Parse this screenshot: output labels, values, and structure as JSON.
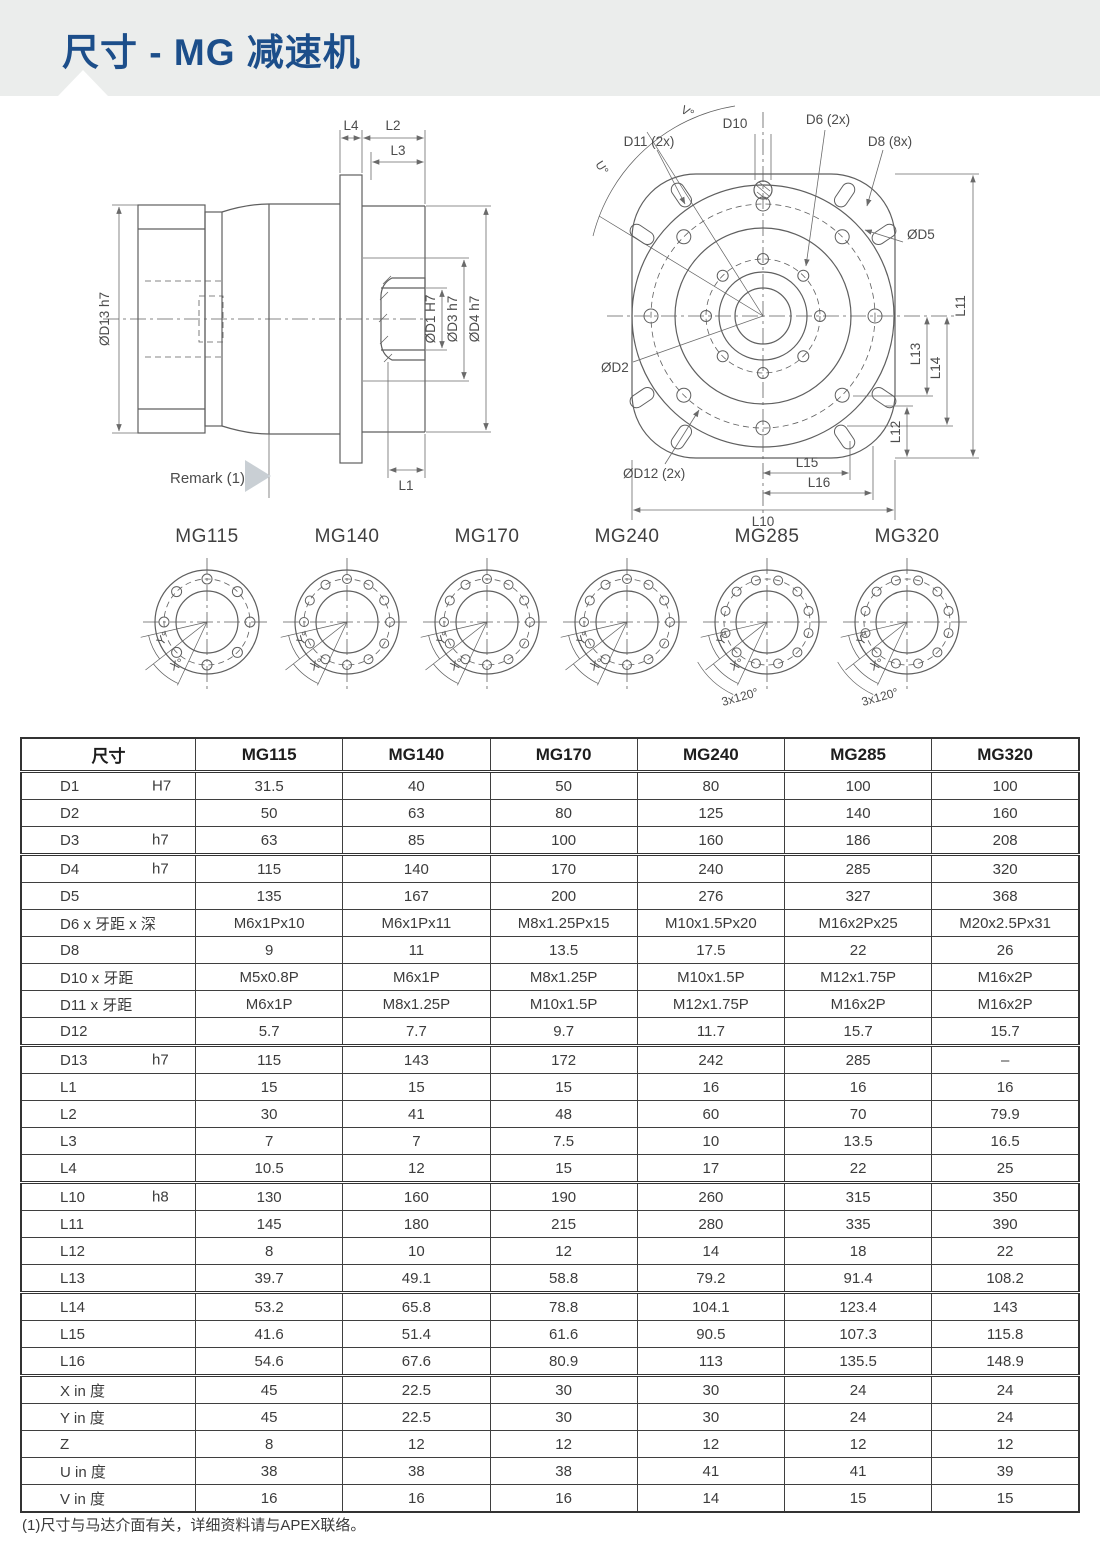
{
  "page": {
    "title": "尺寸 - MG 减速机",
    "footnote": "(1)尺寸与马达介面有关，详细资料请与APEX联络。"
  },
  "colors": {
    "accent": "#1c4e8a",
    "band": "#ebedec",
    "line": "#5f5f5f",
    "table_border": "#333333"
  },
  "drawings": {
    "side_view": {
      "dims": {
        "l4": "L4",
        "l2": "L2",
        "l3": "L3",
        "l1": "L1",
        "d13": "ØD13 h7",
        "d1": "ØD1 H7",
        "d3": "ØD3 h7",
        "d4": "ØD4 h7"
      },
      "remark": "Remark (1)"
    },
    "front_view": {
      "dims": {
        "d10": "D10",
        "d6": "D6 (2x)",
        "d8": "D8 (8x)",
        "d11": "D11 (2x)",
        "d5": "ØD5",
        "d2": "ØD2",
        "d12": "ØD12 (2x)",
        "l15": "L15",
        "l16": "L16",
        "l10": "L10",
        "l11": "L11",
        "l12": "L12",
        "l13": "L13",
        "l14": "L14",
        "v": "V°",
        "u": "U°"
      }
    },
    "flanges": [
      {
        "name": "MG115",
        "holes": 8,
        "y_label": "Y°",
        "x_label": "X°",
        "extra": ""
      },
      {
        "name": "MG140",
        "holes": 12,
        "y_label": "Y°",
        "x_label": "X°",
        "extra": ""
      },
      {
        "name": "MG170",
        "holes": 12,
        "y_label": "Y°",
        "x_label": "X°",
        "extra": ""
      },
      {
        "name": "MG240",
        "holes": 12,
        "y_label": "Y°",
        "x_label": "X°",
        "extra": ""
      },
      {
        "name": "MG285",
        "holes": 12,
        "y_label": "Y°",
        "x_label": "X°",
        "extra": "3x120°"
      },
      {
        "name": "MG320",
        "holes": 12,
        "y_label": "Y°",
        "x_label": "X°",
        "extra": "3x120°"
      }
    ]
  },
  "table": {
    "header": [
      "尺寸",
      "MG115",
      "MG140",
      "MG170",
      "MG240",
      "MG285",
      "MG320"
    ],
    "rows": [
      {
        "label": "D1",
        "tol": "H7",
        "values": [
          "31.5",
          "40",
          "50",
          "80",
          "100",
          "100"
        ]
      },
      {
        "label": "D2",
        "tol": "",
        "values": [
          "50",
          "63",
          "80",
          "125",
          "140",
          "160"
        ]
      },
      {
        "label": "D3",
        "tol": "h7",
        "values": [
          "63",
          "85",
          "100",
          "160",
          "186",
          "208"
        ],
        "group_end": true
      },
      {
        "label": "D4",
        "tol": "h7",
        "values": [
          "115",
          "140",
          "170",
          "240",
          "285",
          "320"
        ]
      },
      {
        "label": "D5",
        "tol": "",
        "values": [
          "135",
          "167",
          "200",
          "276",
          "327",
          "368"
        ]
      },
      {
        "label": "D6 x 牙距 x 深",
        "tol": "",
        "values": [
          "M6x1Px10",
          "M6x1Px11",
          "M8x1.25Px15",
          "M10x1.5Px20",
          "M16x2Px25",
          "M20x2.5Px31"
        ]
      },
      {
        "label": "D8",
        "tol": "",
        "values": [
          "9",
          "11",
          "13.5",
          "17.5",
          "22",
          "26"
        ]
      },
      {
        "label": "D10 x 牙距",
        "tol": "",
        "values": [
          "M5x0.8P",
          "M6x1P",
          "M8x1.25P",
          "M10x1.5P",
          "M12x1.75P",
          "M16x2P"
        ]
      },
      {
        "label": "D11 x 牙距",
        "tol": "",
        "values": [
          "M6x1P",
          "M8x1.25P",
          "M10x1.5P",
          "M12x1.75P",
          "M16x2P",
          "M16x2P"
        ]
      },
      {
        "label": "D12",
        "tol": "",
        "values": [
          "5.7",
          "7.7",
          "9.7",
          "11.7",
          "15.7",
          "15.7"
        ],
        "group_end": true
      },
      {
        "label": "D13",
        "tol": "h7",
        "values": [
          "115",
          "143",
          "172",
          "242",
          "285",
          "–"
        ]
      },
      {
        "label": "L1",
        "tol": "",
        "values": [
          "15",
          "15",
          "15",
          "16",
          "16",
          "16"
        ]
      },
      {
        "label": "L2",
        "tol": "",
        "values": [
          "30",
          "41",
          "48",
          "60",
          "70",
          "79.9"
        ]
      },
      {
        "label": "L3",
        "tol": "",
        "values": [
          "7",
          "7",
          "7.5",
          "10",
          "13.5",
          "16.5"
        ]
      },
      {
        "label": "L4",
        "tol": "",
        "values": [
          "10.5",
          "12",
          "15",
          "17",
          "22",
          "25"
        ],
        "group_end": true
      },
      {
        "label": "L10",
        "tol": "h8",
        "values": [
          "130",
          "160",
          "190",
          "260",
          "315",
          "350"
        ]
      },
      {
        "label": "L11",
        "tol": "",
        "values": [
          "145",
          "180",
          "215",
          "280",
          "335",
          "390"
        ]
      },
      {
        "label": "L12",
        "tol": "",
        "values": [
          "8",
          "10",
          "12",
          "14",
          "18",
          "22"
        ]
      },
      {
        "label": "L13",
        "tol": "",
        "values": [
          "39.7",
          "49.1",
          "58.8",
          "79.2",
          "91.4",
          "108.2"
        ],
        "group_end": true
      },
      {
        "label": "L14",
        "tol": "",
        "values": [
          "53.2",
          "65.8",
          "78.8",
          "104.1",
          "123.4",
          "143"
        ]
      },
      {
        "label": "L15",
        "tol": "",
        "values": [
          "41.6",
          "51.4",
          "61.6",
          "90.5",
          "107.3",
          "115.8"
        ]
      },
      {
        "label": "L16",
        "tol": "",
        "values": [
          "54.6",
          "67.6",
          "80.9",
          "113",
          "135.5",
          "148.9"
        ],
        "group_end": true
      },
      {
        "label": "X in 度",
        "tol": "",
        "values": [
          "45",
          "22.5",
          "30",
          "30",
          "24",
          "24"
        ]
      },
      {
        "label": "Y in 度",
        "tol": "",
        "values": [
          "45",
          "22.5",
          "30",
          "30",
          "24",
          "24"
        ]
      },
      {
        "label": "Z",
        "tol": "",
        "values": [
          "8",
          "12",
          "12",
          "12",
          "12",
          "12"
        ]
      },
      {
        "label": "U in 度",
        "tol": "",
        "values": [
          "38",
          "38",
          "38",
          "41",
          "41",
          "39"
        ]
      },
      {
        "label": "V in 度",
        "tol": "",
        "values": [
          "16",
          "16",
          "16",
          "14",
          "15",
          "15"
        ]
      }
    ]
  }
}
